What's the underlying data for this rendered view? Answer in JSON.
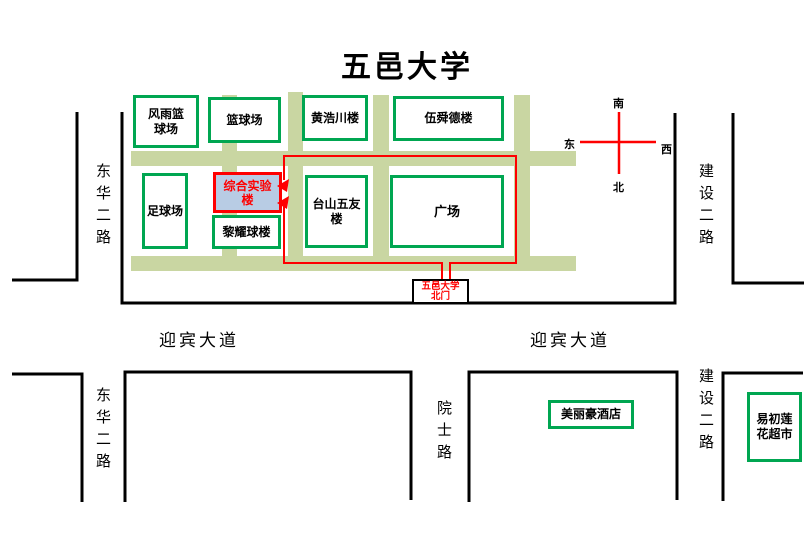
{
  "title": "五邑大学",
  "compass": {
    "top": "南",
    "bottom": "北",
    "left": "东",
    "right": "西"
  },
  "campus": {
    "buildings": [
      {
        "id": "fengyu-basketball-court",
        "label": "风雨篮\n球场"
      },
      {
        "id": "basketball-court",
        "label": "篮球场"
      },
      {
        "id": "huanghaochuan-building",
        "label": "黄浩川楼"
      },
      {
        "id": "wushunde-building",
        "label": "伍舜德楼"
      },
      {
        "id": "football-field",
        "label": "足球场"
      },
      {
        "id": "liyaoqiu-building",
        "label": "黎耀球楼"
      },
      {
        "id": "taishan-wuyou-building",
        "label": "台山五友\n楼"
      },
      {
        "id": "plaza",
        "label": "广场"
      }
    ],
    "highlighted_building": {
      "id": "comprehensive-lab-building",
      "label": "综合实验\n楼"
    },
    "gate": {
      "id": "north-gate",
      "label": "五邑大学\n北门"
    }
  },
  "roads": {
    "donghua_upper": "东华二路",
    "jianshe_upper": "建设二路",
    "yingbin_left": "迎宾大道",
    "yingbin_right": "迎宾大道",
    "donghua_lower": "东华二路",
    "yuanshi": "院士路",
    "jianshe_lower": "建设二路"
  },
  "landmarks": [
    {
      "id": "hotel",
      "label": "美丽豪酒店"
    },
    {
      "id": "supermarket",
      "label": "易初莲\n花超市"
    }
  ],
  "colors": {
    "internal_road_green": "#c9d6a2",
    "building_border_green": "#00a651",
    "route_red": "#fe0000",
    "highlight_fill_blue": "#b8cce4",
    "boundary_black": "#000000"
  }
}
